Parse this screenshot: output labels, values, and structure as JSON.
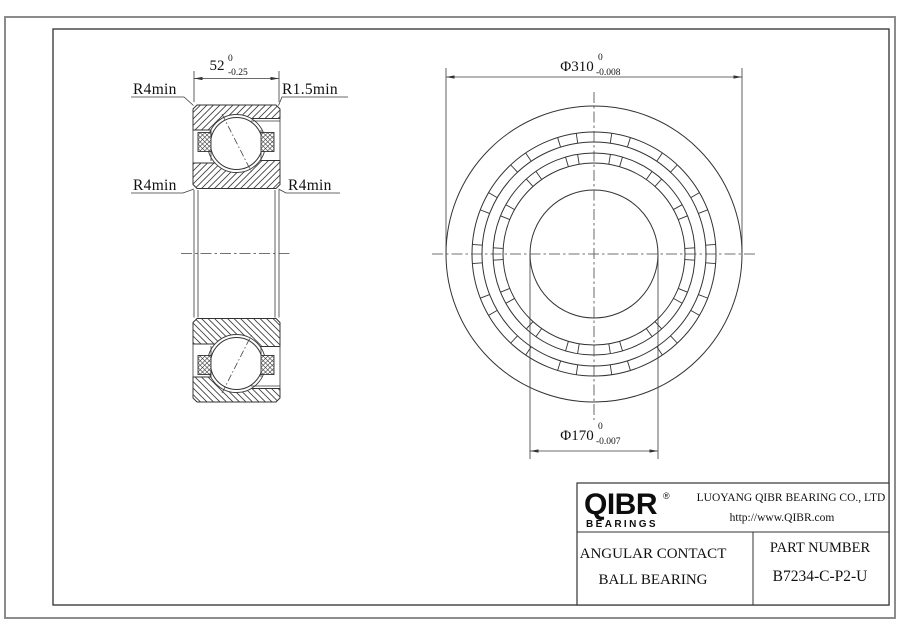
{
  "drawing": {
    "section_view": {
      "dim_width": {
        "value": "52",
        "tol_upper": "0",
        "tol_lower": "-0.25"
      },
      "label_top_left": "R4min",
      "label_top_right": "R1.5min",
      "label_mid_left": "R4min",
      "label_mid_right": "R4min"
    },
    "front_view": {
      "dim_outer": {
        "value": "Φ310",
        "tol_upper": "0",
        "tol_lower": "-0.008"
      },
      "dim_bore": {
        "value": "Φ170",
        "tol_upper": "0",
        "tol_lower": "-0.007"
      }
    }
  },
  "title_block": {
    "logo": {
      "name": "QIBR",
      "registered": "®",
      "tagline": "BEARINGS"
    },
    "company": "LUOYANG QIBR BEARING CO., LTD",
    "website": "http://www.QIBR.com",
    "product_type_line1": "ANGULAR CONTACT",
    "product_type_line2": "BALL BEARING",
    "part_number_label": "PART NUMBER",
    "part_number": "B7234-C-P2-U"
  },
  "colors": {
    "line": "#333333",
    "text": "#111111",
    "frame": "#2f2f2f",
    "page_edge": "#8c8c8c"
  }
}
